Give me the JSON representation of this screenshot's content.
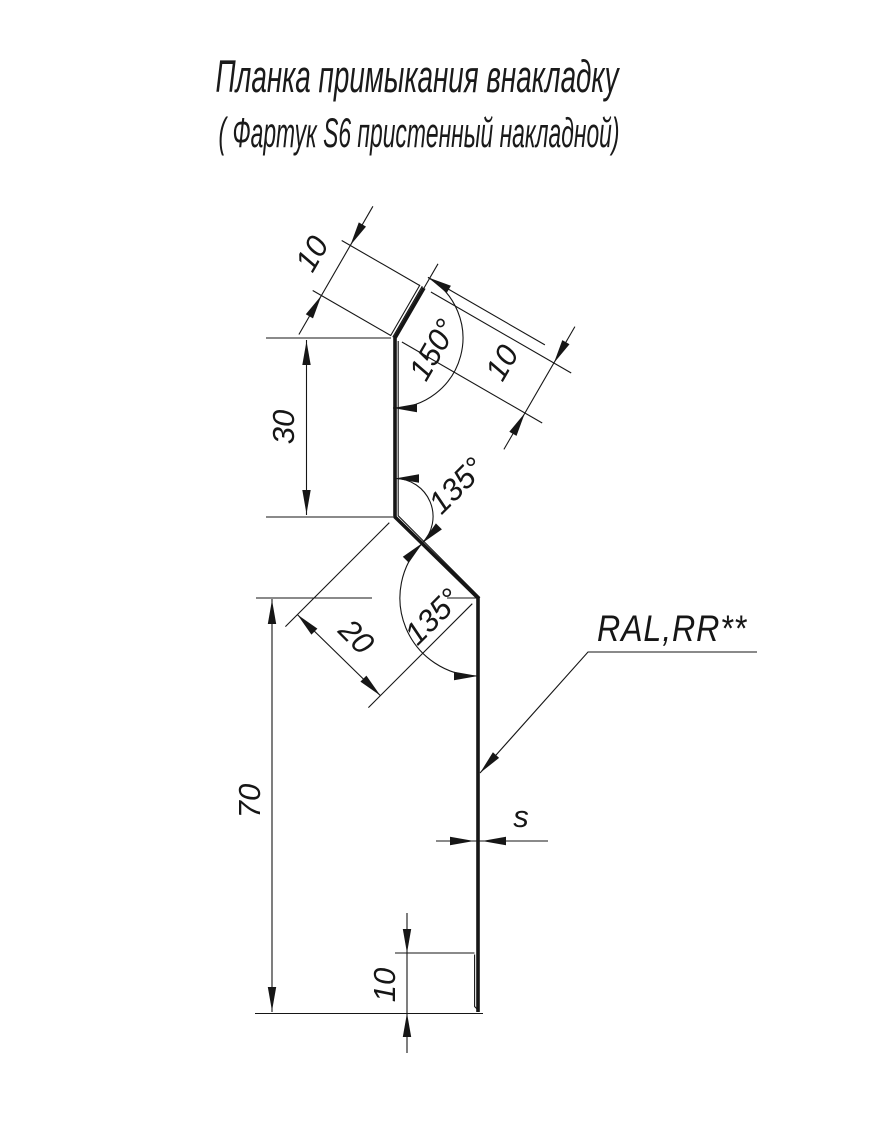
{
  "title": {
    "line1": "Планка примыкания внакладку",
    "line2": "( Фартук S6 пристенный накладной)"
  },
  "dimensions": {
    "hem_top_length": "10",
    "hem_top_angle": "150°",
    "hem_top_return": "10",
    "upper_face_height": "30",
    "upper_bend_angle": "135°",
    "lower_bend_angle": "135°",
    "step_width": "20",
    "lower_face_height": "70",
    "bottom_hem_height": "10",
    "sheet_thickness": "s"
  },
  "callout": {
    "coating": "RAL,RR**"
  },
  "colors": {
    "ink": "#161616",
    "paper": "#ffffff"
  }
}
